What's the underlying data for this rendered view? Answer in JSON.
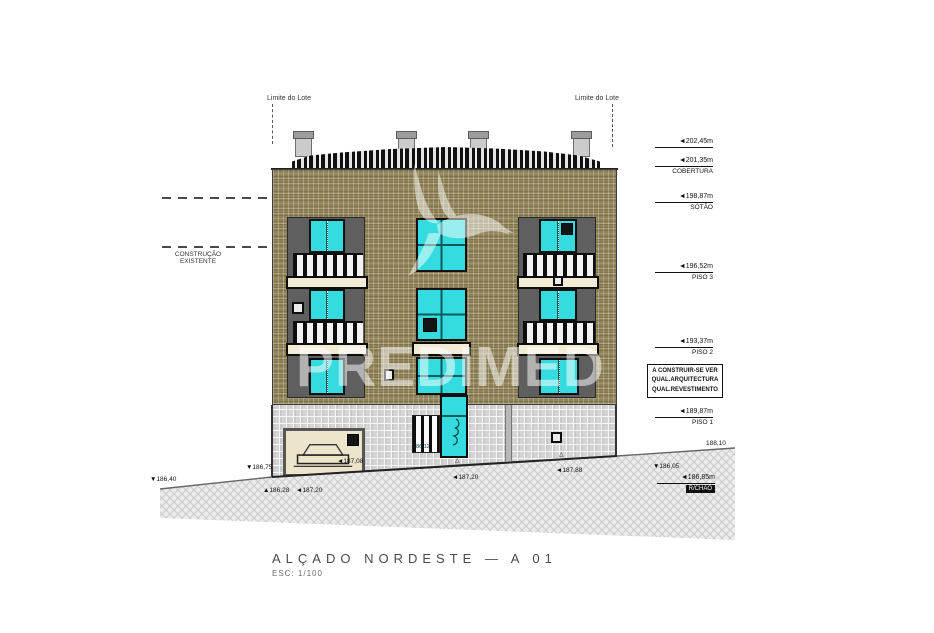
{
  "drawing": {
    "title": "ALÇADO NORDESTE — A 01",
    "scale": "ESC: 1/100",
    "watermark": "PREDIMED",
    "lot_limit_left": "Limite do Lote",
    "lot_limit_right": "Limite do Lote",
    "existing_construction": "CONSTRUÇÃO\nEXISTENTE",
    "note_box": "A CONSTRUIR-SE VER\nQUAL.ARQUITECTURA\nQUAL.REVESTIMENTO",
    "levels": [
      {
        "value": "◄202,45m",
        "name": ""
      },
      {
        "value": "◄201,35m",
        "name": "COBERTURA"
      },
      {
        "value": "◄198,87m",
        "name": "SÓTÃO"
      },
      {
        "value": "◄196,52m",
        "name": "PISO 3"
      },
      {
        "value": "◄193,37m",
        "name": "PISO 2"
      },
      {
        "value": "◄189,87m",
        "name": "PISO 1"
      },
      {
        "value": "◄186,85m",
        "name": "R/CHÃO"
      }
    ],
    "marks": {
      "m188_10": "188,10",
      "m186_05": "▼186,05",
      "m186_40": "▼186,40",
      "m186_75": "▼186,75",
      "m186_28": "▲186,28",
      "m187_20a": "◄187,20",
      "m187_08": "◄187,08",
      "m186_12": "186,12",
      "m187_20b": "◄187,20",
      "m187_88": "◄187,88"
    },
    "colors": {
      "glazing": "#35dcdf",
      "facade": "#8f8257",
      "panel": "#5f5f5f",
      "slab": "#f2ecd6",
      "tiles": "#d4d4d4"
    }
  }
}
